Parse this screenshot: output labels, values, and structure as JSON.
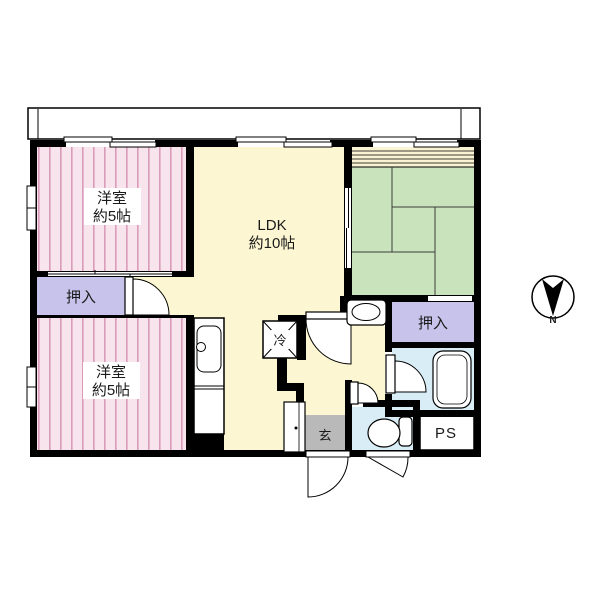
{
  "plan": {
    "bedroom1": {
      "name": "洋室",
      "size": "約5帖"
    },
    "bedroom2": {
      "name": "洋室",
      "size": "約5帖"
    },
    "ldk": {
      "name": "LDK",
      "size": "約10帖"
    },
    "closet1": {
      "label": "押入"
    },
    "closet2": {
      "label": "押入"
    },
    "refrigerator": {
      "label": "冷"
    },
    "entrance": {
      "label": "玄"
    },
    "pipe_space": {
      "label": "PS"
    },
    "compass": {
      "north": "N"
    }
  },
  "colors": {
    "wall": "#000000",
    "flooring_bg": "#f8e4ec",
    "flooring_stripe": "#d99cba",
    "ldk_floor": "#fcf7d2",
    "tatami": "#c9e4bd",
    "closet": "#c7c3ea",
    "wet_area": "#d9edf7",
    "entrance_floor": "#b9b9b9",
    "engawa_strip": "#faf3d3"
  }
}
